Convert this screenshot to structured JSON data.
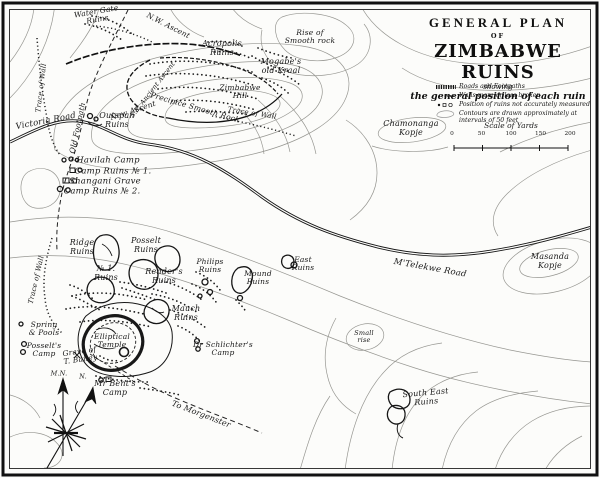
{
  "title": {
    "line1": "GENERAL PLAN",
    "line2": "OF",
    "line3": "ZIMBABWE RUINS",
    "line4": "showing",
    "line5": "the general position of each ruin"
  },
  "legend": {
    "items": [
      {
        "symbol": "road-symbol",
        "text": "Roads and Footpaths"
      },
      {
        "symbol": "wall-symbol",
        "text": "Walls more or less broken"
      },
      {
        "symbol": "ruin-symbol",
        "text": "Position of ruins not accurately measured"
      },
      {
        "symbol": "contour-symbol",
        "text": "Contours are drawn approximately at intervals of 50 feet"
      }
    ]
  },
  "scale": {
    "title": "Scale of Yards",
    "ticks": [
      "0",
      "50",
      "100",
      "150",
      "200"
    ]
  },
  "map": {
    "labels": [
      {
        "id": "label-water-gate-ruins",
        "text": "Water Gate\nRuins",
        "x": 97,
        "y": 16,
        "rot": -10,
        "fs": 7.5
      },
      {
        "id": "label-nw-ascent",
        "text": "N.W. Ascent",
        "x": 168,
        "y": 26,
        "rot": 27,
        "fs": 7.5
      },
      {
        "id": "label-trace-of-wall-nw",
        "text": "Trace of Wall",
        "x": 42,
        "y": 88,
        "rot": -83,
        "fs": 7
      },
      {
        "id": "label-acropolis-ruins",
        "text": "Acropolis\nRuins",
        "x": 222,
        "y": 49,
        "rot": 0,
        "fs": 8
      },
      {
        "id": "label-mogabes-old-kraal",
        "text": "Mogabe's\nold Kraal",
        "x": 281,
        "y": 67,
        "rot": 0,
        "fs": 8
      },
      {
        "id": "label-zimbabwe-hill",
        "text": "Zimbabwe\nHill",
        "x": 240,
        "y": 92,
        "rot": 0,
        "fs": 7.5
      },
      {
        "id": "label-precipice-smooth-rock",
        "text": "Precipice Smooth Rock",
        "x": 195,
        "y": 108,
        "rot": 16,
        "fs": 7.5
      },
      {
        "id": "label-trace-of-wall-se",
        "text": "Trace of Wall",
        "x": 252,
        "y": 114,
        "rot": 9,
        "fs": 7
      },
      {
        "id": "label-se-ancient-ascent",
        "text": "S.E. Ancient Ascent",
        "x": 153,
        "y": 90,
        "rot": -52,
        "fs": 6.5
      },
      {
        "id": "label-new-ascent",
        "text": "New Ascent",
        "x": 133,
        "y": 111,
        "rot": -18,
        "fs": 7.5
      },
      {
        "id": "label-old-footpath",
        "text": "Old Footpath",
        "x": 78,
        "y": 128,
        "rot": -78,
        "fs": 7.5
      },
      {
        "id": "label-victoria-road",
        "text": "Victoria Road",
        "x": 46,
        "y": 122,
        "rot": -11,
        "fs": 8.5
      },
      {
        "id": "label-outspan-ruins",
        "text": "Outspan\nRuins",
        "x": 117,
        "y": 121,
        "rot": 0,
        "fs": 8
      },
      {
        "id": "label-rise-of-smooth-rock",
        "text": "Rise of\nSmooth rock",
        "x": 310,
        "y": 37,
        "rot": 0,
        "fs": 7.5
      },
      {
        "id": "label-chamonanga-kopje",
        "text": "Chamonanga\nKopje",
        "x": 411,
        "y": 129,
        "rot": 0,
        "fs": 8
      },
      {
        "id": "label-havilah-camp",
        "text": "Havilah Camp",
        "x": 108,
        "y": 161,
        "rot": 0,
        "fs": 8.5
      },
      {
        "id": "label-camp-ruins-no1",
        "text": "Camp Ruins № 1.",
        "x": 113,
        "y": 172,
        "rot": 0,
        "fs": 8.5
      },
      {
        "id": "label-shangani-grave",
        "text": "Shangani Grave",
        "x": 105,
        "y": 182,
        "rot": 0,
        "fs": 8.5
      },
      {
        "id": "label-camp-ruins-no2",
        "text": "Camp Ruins № 2.",
        "x": 102,
        "y": 192,
        "rot": 0,
        "fs": 8.5
      },
      {
        "id": "label-ridge-ruins",
        "text": "Ridge\nRuins",
        "x": 82,
        "y": 248,
        "rot": 0,
        "fs": 8
      },
      {
        "id": "label-posselt-ruins",
        "text": "Posselt\nRuins",
        "x": 146,
        "y": 246,
        "rot": 0,
        "fs": 8
      },
      {
        "id": "label-no1-ruins",
        "text": "№ 1.\nRuins",
        "x": 106,
        "y": 274,
        "rot": 0,
        "fs": 8
      },
      {
        "id": "label-renders-ruins",
        "text": "Render's\nRuins",
        "x": 164,
        "y": 277,
        "rot": 0,
        "fs": 8
      },
      {
        "id": "label-philips-ruins",
        "text": "Philips\nRuins",
        "x": 210,
        "y": 266,
        "rot": 0,
        "fs": 7.5
      },
      {
        "id": "label-mound-ruins",
        "text": "Mound\nRuins",
        "x": 258,
        "y": 278,
        "rot": 0,
        "fs": 7.5
      },
      {
        "id": "label-east-ruins",
        "text": "East\nRuins",
        "x": 303,
        "y": 264,
        "rot": 0,
        "fs": 7.5
      },
      {
        "id": "label-mtelekwe-road",
        "text": "M'Telekwe Road",
        "x": 430,
        "y": 269,
        "rot": 10,
        "fs": 8.5
      },
      {
        "id": "label-masanda-kopje",
        "text": "Masanda\nKopje",
        "x": 550,
        "y": 262,
        "rot": 0,
        "fs": 8
      },
      {
        "id": "label-trace-of-wall-w",
        "text": "Trace of Wall",
        "x": 37,
        "y": 280,
        "rot": -77,
        "fs": 7
      },
      {
        "id": "label-spring-and-pools",
        "text": "Spring\n& Pools",
        "x": 44,
        "y": 329,
        "rot": 0,
        "fs": 7.5
      },
      {
        "id": "label-posselts-camp",
        "text": "Posselt's\nCamp",
        "x": 44,
        "y": 350,
        "rot": 0,
        "fs": 7.5
      },
      {
        "id": "label-mauch-ruins",
        "text": "Mauch\nRuins",
        "x": 186,
        "y": 314,
        "rot": 0,
        "fs": 8
      },
      {
        "id": "label-elliptical-temple",
        "text": "Elliptical\nTemple",
        "x": 112,
        "y": 341,
        "rot": 0,
        "fs": 7.5
      },
      {
        "id": "label-dr-schlichters-camp",
        "text": "Dr Schlichter's\nCamp",
        "x": 223,
        "y": 349,
        "rot": 0,
        "fs": 7.5
      },
      {
        "id": "label-grave-of-t-bailey",
        "text": "Grave of\nT. Bailey",
        "x": 80,
        "y": 356,
        "rot": -8,
        "fs": 7.5
      },
      {
        "id": "label-magnetic-north",
        "text": "M.N.",
        "x": 59,
        "y": 374,
        "rot": 0,
        "fs": 6.5
      },
      {
        "id": "label-true-north",
        "text": "N.",
        "x": 83,
        "y": 377,
        "rot": 0,
        "fs": 6.5
      },
      {
        "id": "label-mr-bents-camp",
        "text": "Mr Bent's\nCamp",
        "x": 115,
        "y": 389,
        "rot": 0,
        "fs": 8
      },
      {
        "id": "label-to-morgenster",
        "text": "To Morgenster",
        "x": 201,
        "y": 415,
        "rot": 21,
        "fs": 8
      },
      {
        "id": "label-small-rise",
        "text": "Small\nrise",
        "x": 364,
        "y": 337,
        "rot": 0,
        "fs": 6.5
      },
      {
        "id": "label-south-east-ruins",
        "text": "South East\nRuins",
        "x": 426,
        "y": 398,
        "rot": -5,
        "fs": 8
      }
    ]
  }
}
